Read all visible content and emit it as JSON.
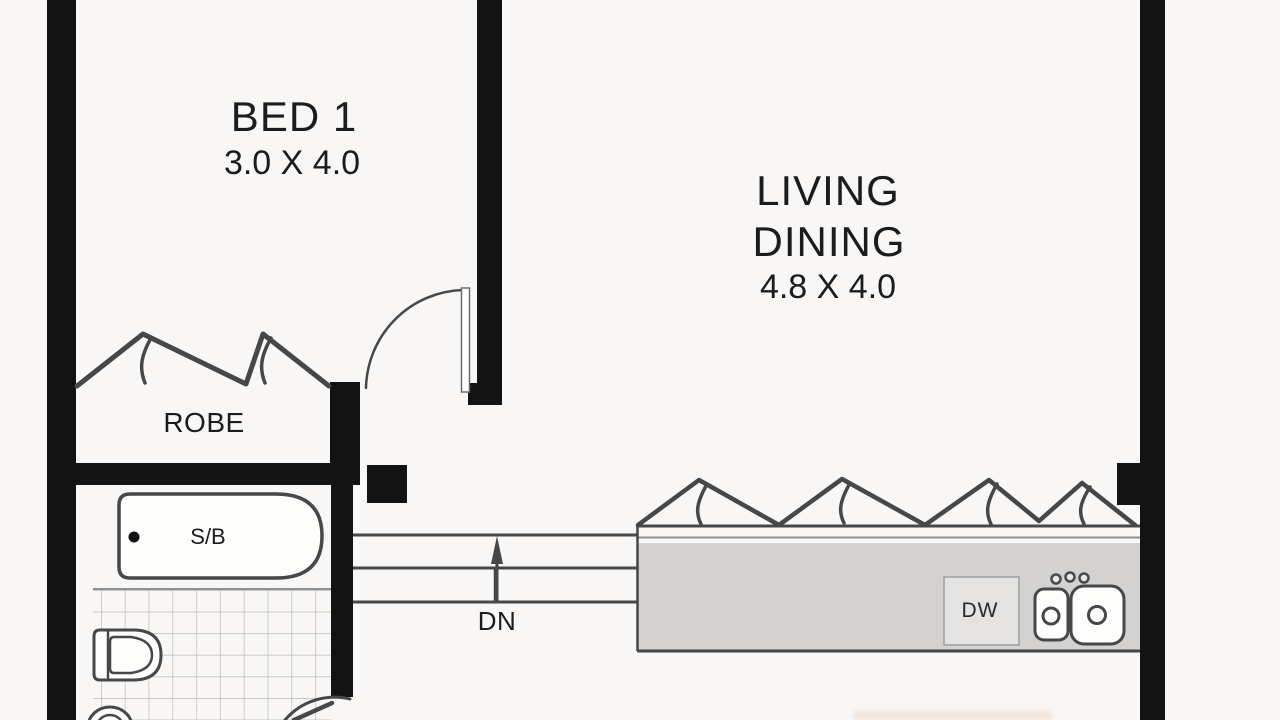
{
  "title": "Apartment floor plan",
  "colors": {
    "paper": "#f8f7f5",
    "wall": "#131313",
    "line": "#474747",
    "light_line": "#8f8f8f",
    "bench": "#d3d2d0",
    "appliance": "#e4e3e1",
    "tile_line": "#bdbbb8",
    "fixture_fill": "#fdfdfc",
    "text": "#1c1c1c"
  },
  "rooms": {
    "bed1": {
      "name": "BED 1",
      "dimensions": "3.0 X 4.0"
    },
    "living": {
      "name_line1": "LIVING",
      "name_line2": "DINING",
      "dimensions": "4.8 X 4.0"
    },
    "robe": {
      "name": "ROBE"
    },
    "bathroom": {
      "bath_label": "S/B"
    },
    "stairs": {
      "direction_label": "DN"
    },
    "kitchen": {
      "dishwasher_label": "DW"
    }
  }
}
